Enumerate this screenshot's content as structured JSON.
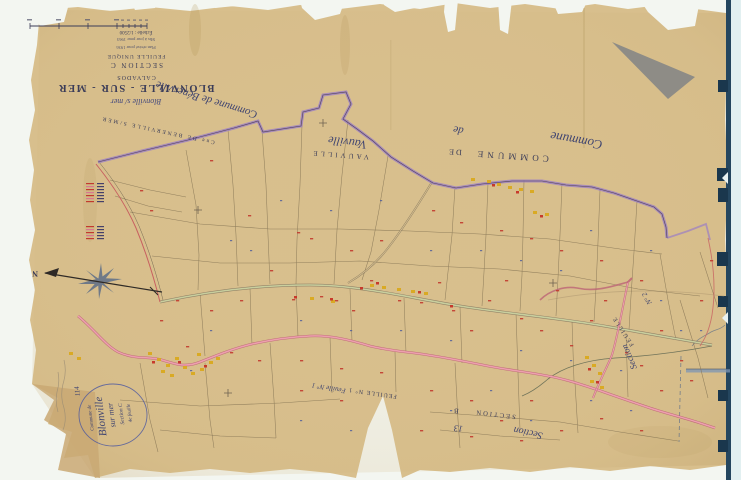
{
  "title_block": {
    "signature": "Blonville s/ mer",
    "commune": "BLONVILLE - SUR - MER",
    "department": "CALVADOS",
    "section": "SECTION C",
    "sheet": "FEUILLE UNIQUE",
    "note1": "Plan révisé pour 1936",
    "note2": "Mis à jour pour 1963",
    "scale": "Échelle : 1/2500"
  },
  "neighbors": {
    "benerville_printed": "Cne DE BENERVILLE S/MER",
    "benerville_script": "Commune de Bénerville",
    "commune_printed": "COMMUNE",
    "de_printed": "DE",
    "vauville_printed": "VAUVILLE",
    "commune_script": "Commune",
    "de_script": "de",
    "vauville_script": "Vauville"
  },
  "sheet_refs": {
    "feuille2_printed": "FEUILLE",
    "feuille2_number": "N° 2",
    "section_script": "Section",
    "feuille1_printed": "FEUILLE N° 1",
    "feuille1_script": "Feuille N° 1",
    "section_b_printed": "SECTION",
    "section_b_letter": "B",
    "handwritten_note": "13"
  },
  "compass": {
    "north_label": "N"
  },
  "stamp": {
    "line1": "Commune de",
    "line2": "Blonville",
    "line3": "sur mer",
    "line4": "Section C",
    "line5": "4e feuille",
    "annotation": "114"
  },
  "colors": {
    "paper": "#d8bf8d",
    "scanner_bg": "#f3f6f1",
    "scanner_right_strip": "#e2f0f1",
    "binding_navy": "#24465f",
    "boundary_purple": "#9b7ec4",
    "road_pink": "#e89aac",
    "road_green": "#c9cf9e",
    "parcel_line": "#857454",
    "number_red": "#c23a2e",
    "mark_blue": "#4a5a9e",
    "building_yellow": "#d9a91f",
    "building_red": "#c63326",
    "ink_blue": "#3b3c58",
    "stamp_blue": "#4a56a0",
    "triangle_gray": "#8e8c86"
  }
}
